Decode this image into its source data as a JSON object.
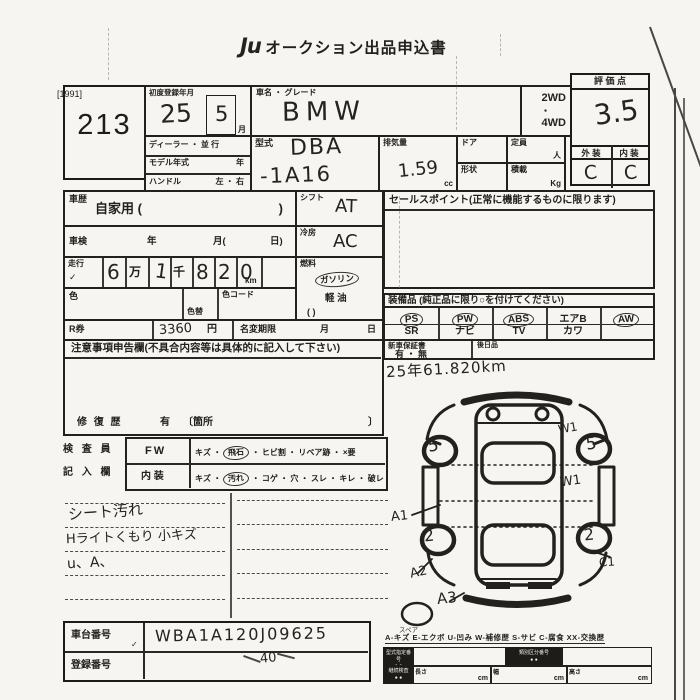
{
  "page": {
    "code": "[1991]",
    "lot": "213",
    "logo": "Ju",
    "title": "オークション出品申込書"
  },
  "rowA": {
    "first_reg_label": "初度登録年月",
    "first_reg_year": "25",
    "first_reg_month": "5",
    "month_unit": "月",
    "car_name_label": "車名 ・ グレード",
    "car_name": "BMW",
    "wd2": "2WD",
    "dot": "・",
    "wd4": "4WD"
  },
  "score": {
    "label": "評 価 点",
    "value": "3.5",
    "ext_label": "外 装",
    "int_label": "内 装",
    "ext": "C",
    "int": "C"
  },
  "rowB": {
    "dealer": "ディーラー ・ 並 行",
    "model_year": "モデル年式",
    "year_unit": "年",
    "handle": "ハンドル",
    "handle_opts": "左 ・ 右",
    "model_code_label": "型式",
    "model_code": "DBA",
    "model_code2": "-1A16",
    "disp_label": "排気量",
    "disp": "1.59",
    "disp_unit": "cc",
    "door": "ドア",
    "cap": "定員",
    "cap_unit": "人",
    "shape": "形状",
    "load": "積載",
    "load_unit": "Kg"
  },
  "left": {
    "history_label": "車歴",
    "history": "自家用 (",
    "paren": ")",
    "shaken": "車検",
    "y": "年",
    "m": "月(",
    "d": "日)",
    "mileage_label": "走行",
    "check": "✓",
    "mil": {
      "d1": "6",
      "u1": "万",
      "d2": "1",
      "u2": "千",
      "d3": "8",
      "d4": "2",
      "d5": "0",
      "unit": "km"
    },
    "color": "色",
    "color_change": "色替",
    "color_code": "色コード"
  },
  "mid": {
    "shift_label": "シフト",
    "shift": "AT",
    "ac_label": "冷房",
    "ac": "AC",
    "fuel_label": "燃料",
    "gasoline": "ガソリン",
    "diesel": "軽 油",
    "paren": "(        )"
  },
  "sales": {
    "header": "セールスポイント(正常に機能するものに限ります)"
  },
  "equip": {
    "header": "装備品 (純正品に限り○を付けてください)",
    "r1c1": "PS",
    "r1c2": "PW",
    "r1c3": "ABS",
    "r1c4": "エアB",
    "r1c5": "AW",
    "r2c1": "SR",
    "r2c2": "ナビ",
    "r2c3": "TV",
    "r2c4": "カワ",
    "r2c5": ""
  },
  "warranty": {
    "label": "新車保証書",
    "opts": "有 ・ 無",
    "later": "後日品"
  },
  "odo_note": "25年61.820km",
  "rticket": {
    "label": "R券",
    "value": "3360",
    "unit": "円",
    "rename": "名変期限",
    "m": "月",
    "d": "日"
  },
  "notice": {
    "header": "注意事項申告欄(不具合内容等は具体的に記入して下さい)",
    "repair": "修 復 歴",
    "has": "有",
    "loc": "〔箇所",
    "close": "〕"
  },
  "inspector": {
    "label1": "検 査 員",
    "label2": "記 入 欄",
    "r1h": "FW",
    "r1a": "キズ ・",
    "r1c": "飛石",
    "r1b": "・ ヒビ割 ・ リペア跡 ・ ×要",
    "r2h": "内 装",
    "r2a": "キズ ・",
    "r2c": "汚れ",
    "r2b": "・ コゲ ・ 穴 ・ スレ ・ キレ ・ 破レ"
  },
  "notes": {
    "l1": "シート汚れ",
    "l2": "Hライトくもり 小キズ",
    "l3": "u、A、"
  },
  "diagram": {
    "fl": "5",
    "fr": "5",
    "rl": "2",
    "rr": "2",
    "w1a": "W1",
    "w1b": "W1",
    "a1": "A1",
    "a2": "A2",
    "a3": "A3",
    "c1": "C1",
    "spare": "スペア"
  },
  "legend": "A-キズ  E-エクボ  U-凹み  W-補修歴  S-サビ  C-腐食  XX-交換歴",
  "chassis": {
    "label": "車台番号",
    "check": "✓",
    "value": "WBA1A120J09625",
    "note": "40",
    "reg_label": "登録番号"
  },
  "bottom": {
    "b1": "型式指定番号",
    "b1d": "● ●",
    "b2": "類別区分番号",
    "b2d": "● ●",
    "b3": "継続検査",
    "b3d": "● ●",
    "len": "長さ",
    "w": "幅",
    "h": "高さ",
    "cm": "cm"
  }
}
